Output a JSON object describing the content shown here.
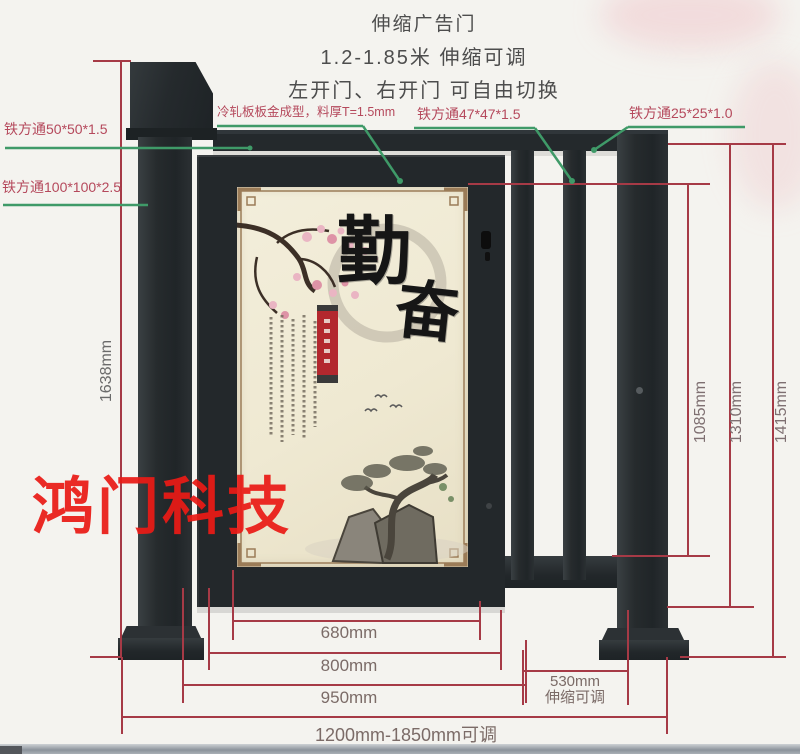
{
  "header": {
    "line1": "伸缩广告门",
    "line2": "1.2-1.85米 伸缩可调",
    "line3": "左开门、右开门 可自由切换"
  },
  "callouts": {
    "steel_tube_50": "铁方通50*50*1.5",
    "steel_tube_100": "铁方通100*100*2.5",
    "cold_rolled_panel": "冷轧板板金成型，料厚T=1.5mm",
    "steel_tube_47": "铁方通47*47*1.5",
    "steel_tube_25": "铁方通25*25*1.0"
  },
  "dimensions": {
    "total_height": "1638mm",
    "opening_height": "1085mm",
    "rail_height": "1310mm",
    "post_height": "1415mm",
    "poster_width": "680mm",
    "door_width": "800mm",
    "door_outer_width": "950mm",
    "extension_width": "530mm",
    "extension_note": "伸缩可调",
    "total_width_range": "1200mm-1850mm可调"
  },
  "poster": {
    "calligraphy_char_1": "勤",
    "calligraphy_char_2": "奋"
  },
  "watermark": "鸿门科技",
  "colors": {
    "dimension_line": "#a63a46",
    "callout_line": "#3f9a68",
    "callout_text": "#b5495c",
    "watermark_red": "#ea1b16",
    "frame_dark": "#23282b",
    "poster_cream": "#efe9d2"
  }
}
